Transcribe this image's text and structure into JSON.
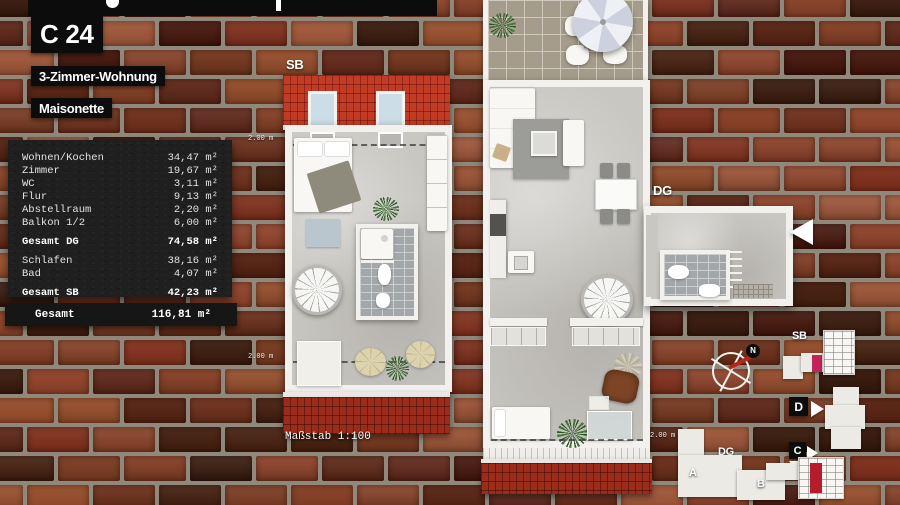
{
  "header": {
    "unit_id": "C 24",
    "type_label": "3-Zimmer-Wohnung",
    "style_label": "Maisonette"
  },
  "area_table": {
    "dg_rows": [
      {
        "label": "Wohnen/Kochen",
        "value": "34,47 m²"
      },
      {
        "label": "Zimmer",
        "value": "19,67 m²"
      },
      {
        "label": "WC",
        "value": "3,11 m²"
      },
      {
        "label": "Flur",
        "value": "9,13 m²"
      },
      {
        "label": "Abstellraum",
        "value": "2,20 m²"
      },
      {
        "label": "Balkon 1/2",
        "value": "6,00 m²"
      }
    ],
    "dg_total": {
      "label": "Gesamt DG",
      "value": "74,58 m²"
    },
    "sb_rows": [
      {
        "label": "Schlafen",
        "value": "38,16 m²"
      },
      {
        "label": "Bad",
        "value": "4,07 m²"
      }
    ],
    "sb_total": {
      "label": "Gesamt SB",
      "value": "42,23 m²"
    },
    "grand_total": {
      "label": "Gesamt",
      "value": "116,81 m²"
    }
  },
  "plans": {
    "sb_label": "SB",
    "dg_label": "DG",
    "scale_label": "Maßstab 1:100",
    "height_marker": "2.00 m"
  },
  "site_plan": {
    "sb_label": "SB",
    "dg_label": "DG",
    "building_a": "A",
    "building_b": "B",
    "building_c": "C",
    "building_d": "D",
    "north": "N"
  },
  "colors": {
    "roof_bright": "#c23b24",
    "roof_dark": "#9c2c1a",
    "label_bg": "#0c0c0c",
    "panel_bg": "#1f1f1f",
    "floor": "#c9c7c2",
    "site_highlight_magenta": "#c02458",
    "site_highlight_red": "#b51d2e"
  }
}
